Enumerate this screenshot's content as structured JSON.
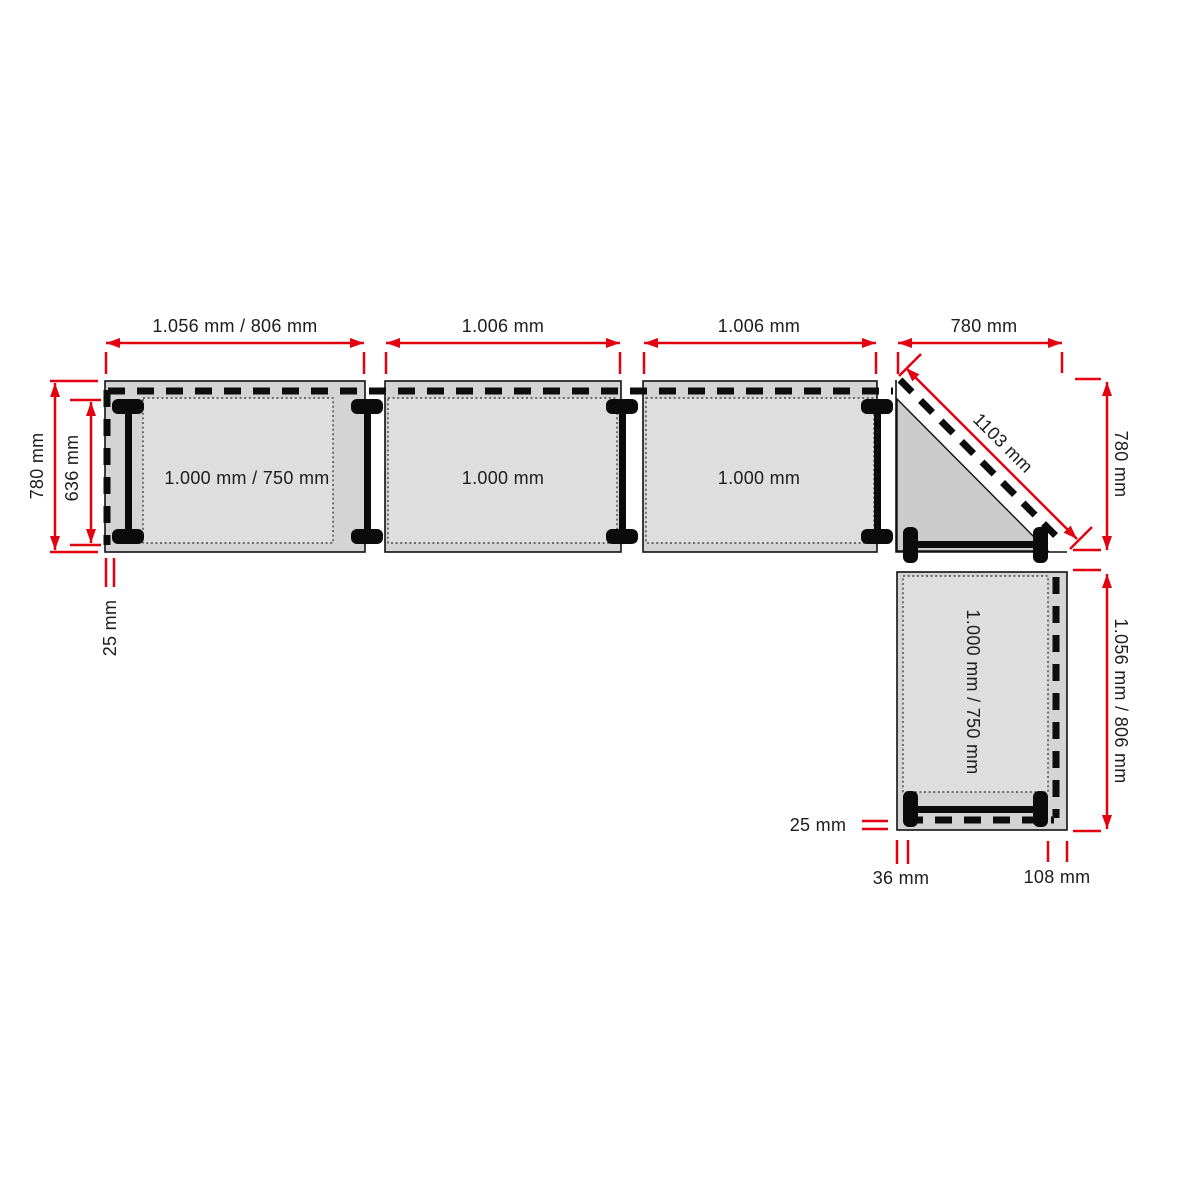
{
  "diagram": {
    "type": "desk-configuration-plan",
    "colors": {
      "dimension_red": "#e3000f",
      "desk_fill": "#d4d4d4",
      "surface_fill": "#dedede",
      "corner_fill": "#cccccc",
      "outline": "#111111",
      "background": "#ffffff"
    }
  },
  "desks": {
    "desk1": {
      "surface": "1.000 mm / 750 mm",
      "width": "1.056 mm / 806 mm"
    },
    "desk2": {
      "surface": "1.000 mm",
      "width": "1.006 mm"
    },
    "desk3": {
      "surface": "1.000 mm",
      "width": "1.006 mm"
    },
    "corner": {
      "width": "780 mm",
      "depth": "780 mm",
      "diagonal": "1103 mm"
    },
    "desk4": {
      "surface": "1.000 mm / 750 mm",
      "height": "1.056 mm / 806 mm"
    }
  },
  "dims": {
    "depth_outer": "780 mm",
    "depth_inner": "636 mm",
    "edge_offset_left": "25 mm",
    "edge_offset_right": "25 mm",
    "offset_36": "36 mm",
    "offset_108": "108 mm"
  }
}
